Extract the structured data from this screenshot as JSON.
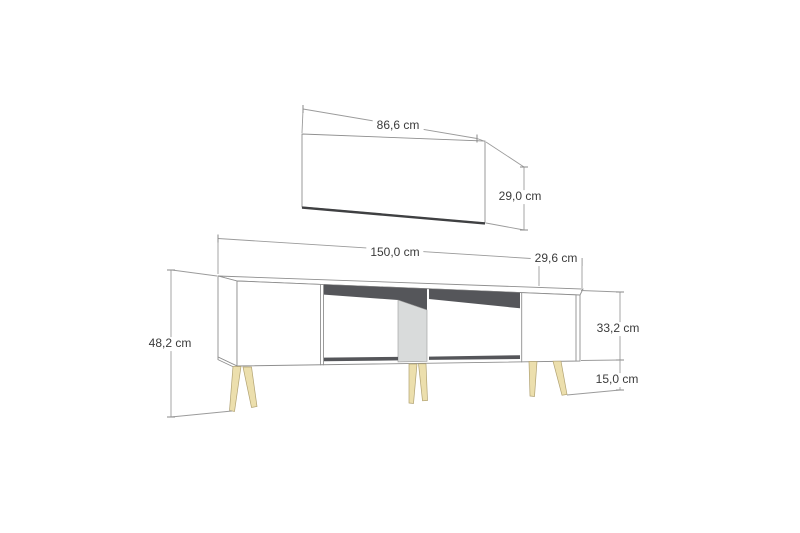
{
  "diagram": {
    "kind": "furniture-dimension-drawing",
    "units": "cm",
    "wall_panel": {
      "width_label": "86,6 cm",
      "height_label": "29,0 cm"
    },
    "tv_stand": {
      "width_label": "150,0 cm",
      "depth_label": "29,6 cm",
      "total_height_label": "48,2 cm",
      "body_height_label": "33,2 cm",
      "leg_height_label": "15,0 cm"
    }
  },
  "colors": {
    "background": "#ffffff",
    "line": "#8f8f8f",
    "dark_edge": "#3f4042",
    "shadow": "#55565a",
    "divider": "#d9dbdb",
    "side_panel": "#e8eaea",
    "top_face": "#fdfdfd",
    "front_face": "#ffffff",
    "leg_fill": "#ecdfad",
    "leg_stroke": "#b1a272",
    "text": "#3b3b3b"
  }
}
